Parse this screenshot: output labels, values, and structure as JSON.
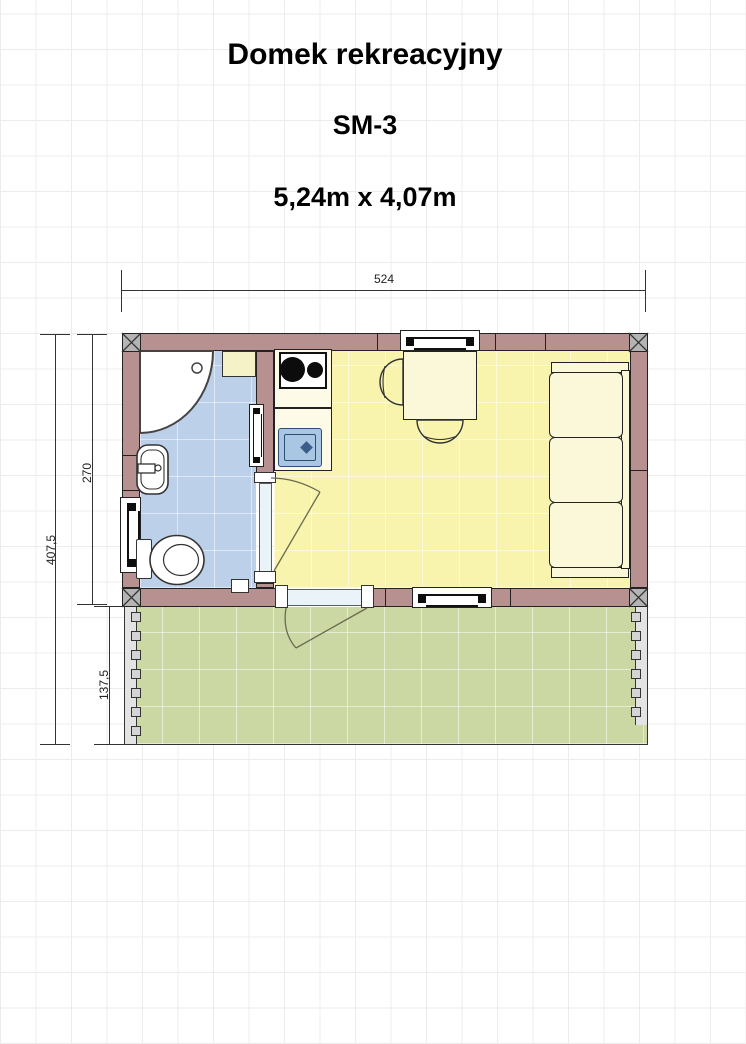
{
  "title": {
    "name": "Domek rekreacyjny",
    "model": "SM-3",
    "size": "5,24m x 4,07m"
  },
  "dimensions": {
    "width": "524",
    "total_depth": "407,5",
    "house_depth": "270",
    "terrace_depth": "137,5"
  },
  "colors": {
    "wall": "#b79090",
    "bathroom_floor": "#bdd0e9",
    "room_floor": "#f8f4ae",
    "terrace": "#ccd8a3",
    "furniture": "#fbf7d9",
    "counter": "#fdfae7",
    "cabinet": "#f6f2c8",
    "kitchen_sink": "#a9c6e3",
    "kitchen_sink_edge": "#2f4e73",
    "door_opening": "#e9f3f8",
    "swing_line": "#6a6a50"
  },
  "rooms": [
    {
      "name": "bathroom"
    },
    {
      "name": "main-room"
    },
    {
      "name": "terrace"
    }
  ],
  "fixtures": [
    "corner-shower",
    "washbasin",
    "toilet",
    "bathroom-cabinet",
    "kitchen-counter",
    "stove-two-burners",
    "kitchen-sink",
    "dining-table",
    "chair",
    "chair",
    "three-seat-sofa"
  ],
  "openings": {
    "windows": 4,
    "exterior_doors": 1,
    "interior_doors": 1
  }
}
